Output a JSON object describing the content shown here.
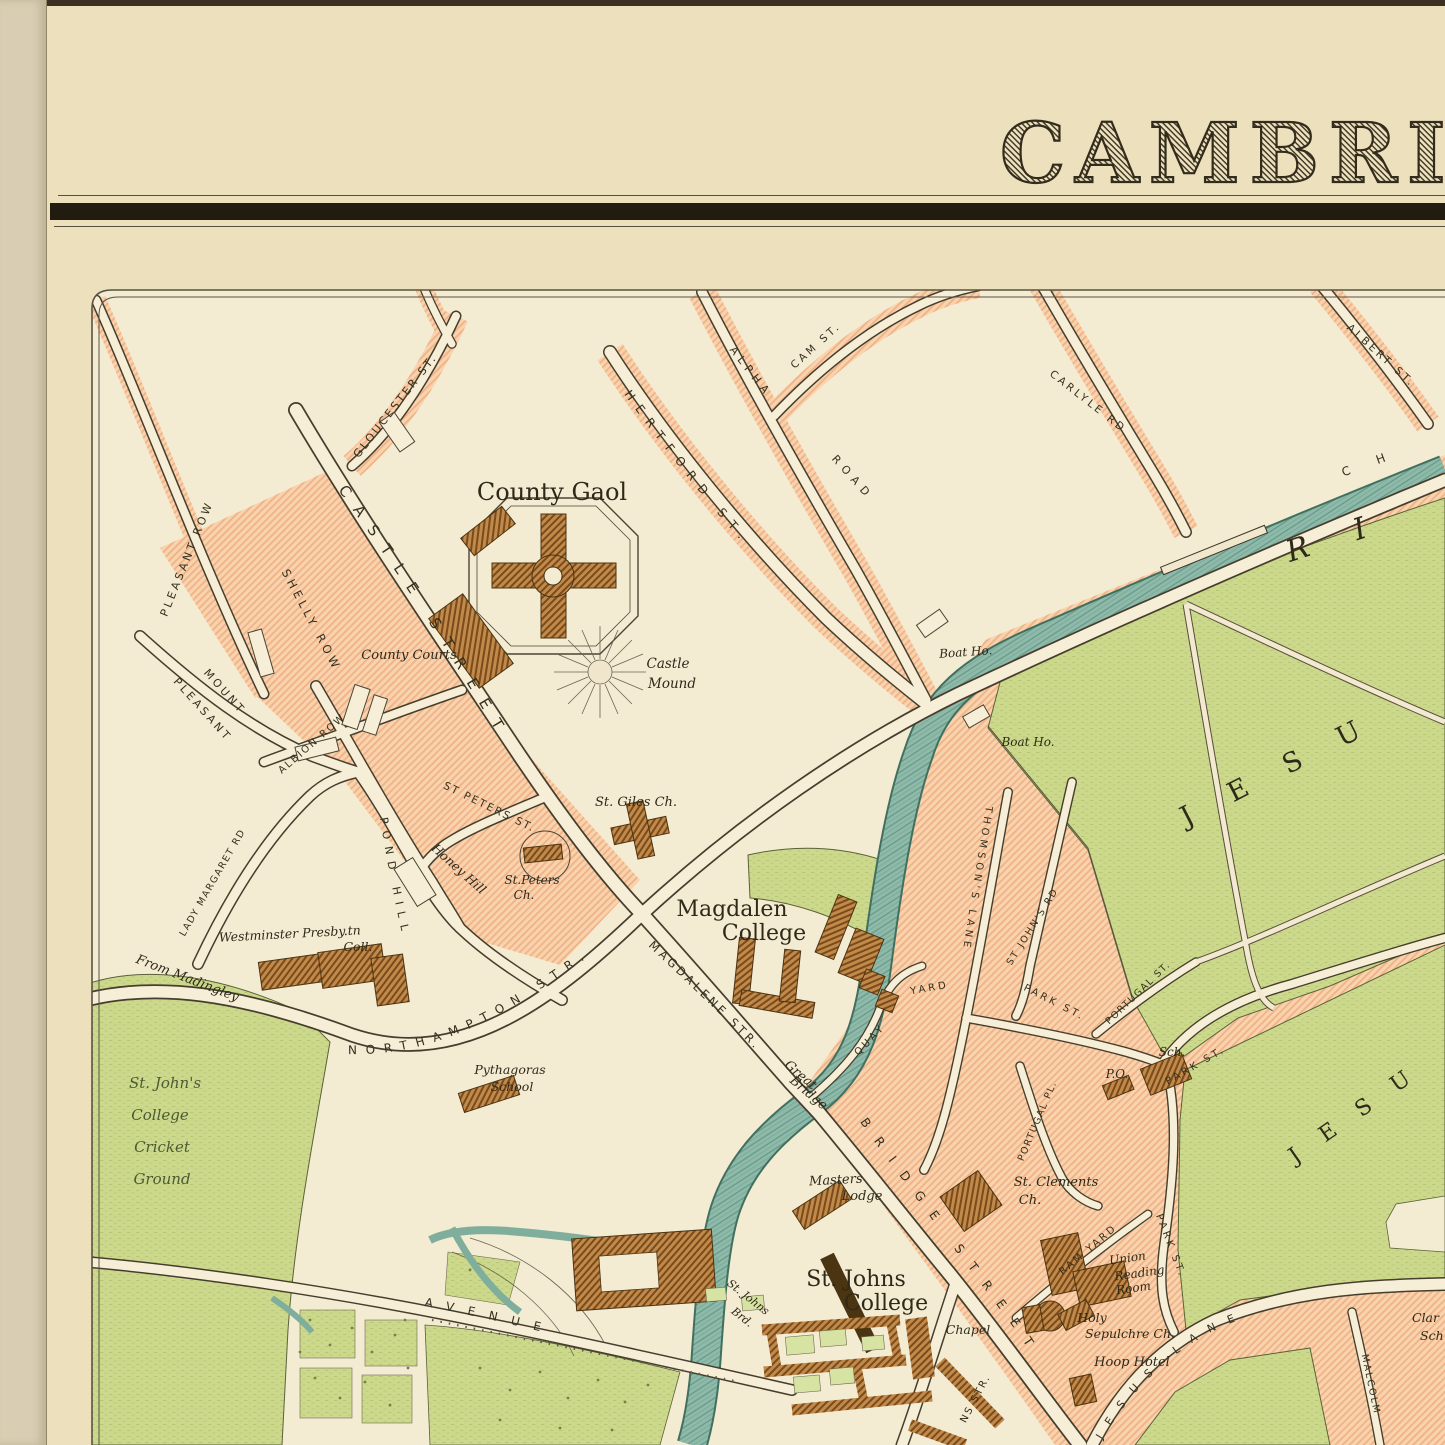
{
  "title": "CAMBRIDGE",
  "map_colors": {
    "paper": "#ece0bd",
    "map_field": "#f4ebd3",
    "built_area_pink": "#f6cda7",
    "green_space": "#ccd88c",
    "river_teal": "#8fbaa9",
    "building_brown": "#b97f3e",
    "ink": "#35301f"
  },
  "labels": {
    "gloucester_st": "GLOUCESTER ST.",
    "pleasant_row": "PLEASANT ROW",
    "shelly_row": "SHELLY ROW",
    "castle_street": "CASTLE STREET",
    "mount": "MOUNT",
    "pleasant": "PLEASANT",
    "albion_row": "ALBION ROW",
    "lady_margaret_rd": "LADY MARGARET RD",
    "pond_hill": "POND HILL",
    "st_peters_st": "ST PETERS ST.",
    "hertford_st": "HERTFORD ST.",
    "alpha": "ALPHA",
    "road": "ROAD",
    "cam_st": "CAM ST.",
    "carlyle_rd": "CARLYLE RD",
    "albert_st": "ALBERT ST.",
    "chesterton": "CH",
    "river": "RI",
    "northampton_str": "NORTHAMPTON STR.",
    "magdalene_str": "MAGDALENE STR.",
    "great": "Great",
    "bridge": "Bridge",
    "quay": "QUAY",
    "yard": "YARD",
    "thomsons_lane": "THOMSON'S LANE",
    "st_johns_rd": "ST JOHN'S RD",
    "park_st_upper": "PARK ST.",
    "portugal_st": "PORTUGAL ST.",
    "portugal_pl": "PORTUGAL PL.",
    "park_st_diag": "PARK ST.",
    "park_st_lower": "PARK ST.",
    "ram_yard": "RAM YARD",
    "bridge_street": "BRIDGE STREET",
    "ns_str": "NS STR.",
    "jesus_lane": "JESUS LANE",
    "malcolm": "MALCOLM",
    "avenue": "AVENUE",
    "county_gaol": "County Gaol",
    "county_courts": "County Courts",
    "castle1": "Castle",
    "castle2": "Mound",
    "st_giles": "St. Giles Ch.",
    "st_peters1": "St.Peters",
    "st_peters2": "Ch.",
    "honey_hill": "Honey Hill",
    "westminster1": "Westminster Presby.tn",
    "westminster2": "Coll.",
    "from_madingley": "From Madingley",
    "cricket1": "St. John's",
    "cricket2": "College",
    "cricket3": "Cricket",
    "cricket4": "Ground",
    "pythagoras1": "Pythagoras",
    "pythagoras2": "School",
    "magdalen1": "Magdalen",
    "magdalen2": "College",
    "boat_ho1": "Boat Ho.",
    "boat_ho2": "Boat Ho.",
    "jesu1": "JESU",
    "jesu2": "JESU",
    "masters1": "Masters",
    "masters2": "Lodge",
    "stjohns1": "St. Johns",
    "stjohns2": "College",
    "chapel": "Chapel",
    "stjbrd1": "St. Johns",
    "stjbrd2": "Brd.",
    "clements1": "St. Clements",
    "clements2": "Ch.",
    "union1": "Union",
    "union2": "Reading",
    "union3": "Room",
    "holy1": "Holy",
    "holy2": "Sepulchre Ch.",
    "hoop": "Hoop Hotel",
    "sch": "Sch.",
    "po": "P.O.",
    "clar1": "Clar",
    "clar2": "Sch"
  }
}
